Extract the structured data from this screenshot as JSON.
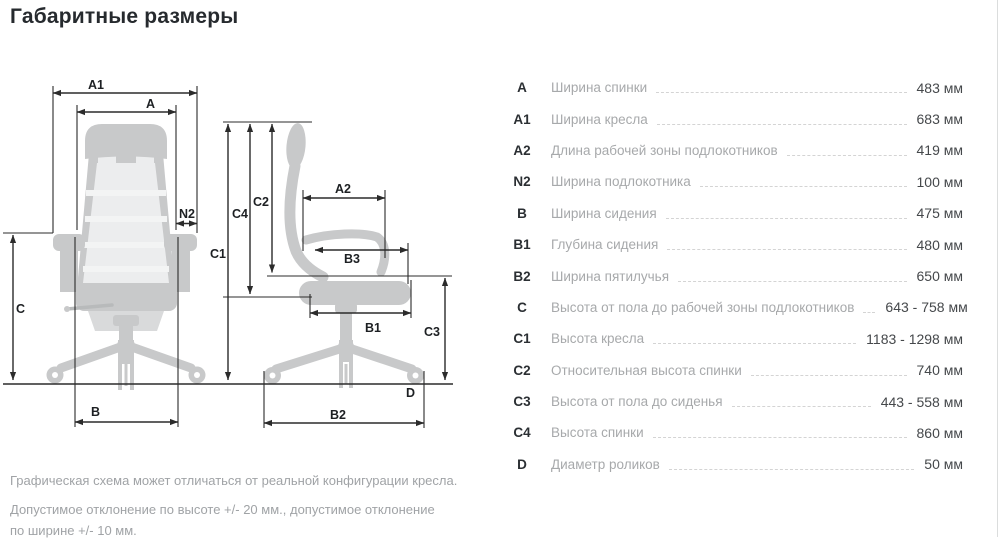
{
  "title": "Габаритные размеры",
  "table": {
    "rows": [
      {
        "label": "A",
        "desc": "Ширина спинки",
        "value": "483 мм"
      },
      {
        "label": "A1",
        "desc": "Ширина кресла",
        "value": "683 мм"
      },
      {
        "label": "A2",
        "desc": "Длина рабочей зоны подлокотников",
        "value": "419 мм"
      },
      {
        "label": "N2",
        "desc": "Ширина подлокотника",
        "value": "100 мм"
      },
      {
        "label": "B",
        "desc": "Ширина сидения",
        "value": "475 мм"
      },
      {
        "label": "B1",
        "desc": "Глубина сидения",
        "value": "480 мм"
      },
      {
        "label": "B2",
        "desc": "Ширина пятилучья",
        "value": "650 мм"
      },
      {
        "label": "C",
        "desc": "Высота от пола до рабочей зоны подлокотников",
        "value": "643 - 758 мм"
      },
      {
        "label": "C1",
        "desc": "Высота кресла",
        "value": "1183 - 1298 мм"
      },
      {
        "label": "C2",
        "desc": "Относительная высота спинки",
        "value": "740 мм"
      },
      {
        "label": "C3",
        "desc": "Высота от пола до сиденья",
        "value": "443 - 558 мм"
      },
      {
        "label": "C4",
        "desc": "Высота спинки",
        "value": "860 мм"
      },
      {
        "label": "D",
        "desc": "Диаметр роликов",
        "value": "50 мм"
      }
    ]
  },
  "notes": {
    "schema": "Графическая схема может отличаться от реальной конфигурации кресла.",
    "tolerance": "Допустимое отклонение по высоте +/- 20 мм., допустимое отклонение по ширине +/- 10 мм."
  },
  "diagram": {
    "marks": {
      "a1": "A1",
      "a": "A",
      "n2": "N2",
      "c": "C",
      "b": "B",
      "c1": "C1",
      "c2": "C2",
      "c4": "C4",
      "a2": "A2",
      "b3": "B3",
      "b1": "B1",
      "c3": "C3",
      "d": "D",
      "b2": "B2"
    }
  },
  "colors": {
    "chair_body": "#c8c9ca",
    "chair_mesh": "#ecedee",
    "dimension_line": "#2b2b2b",
    "text_dark": "#262a2e",
    "text_muted": "#a7a9ab",
    "leader_dash": "#d4d4d4"
  }
}
